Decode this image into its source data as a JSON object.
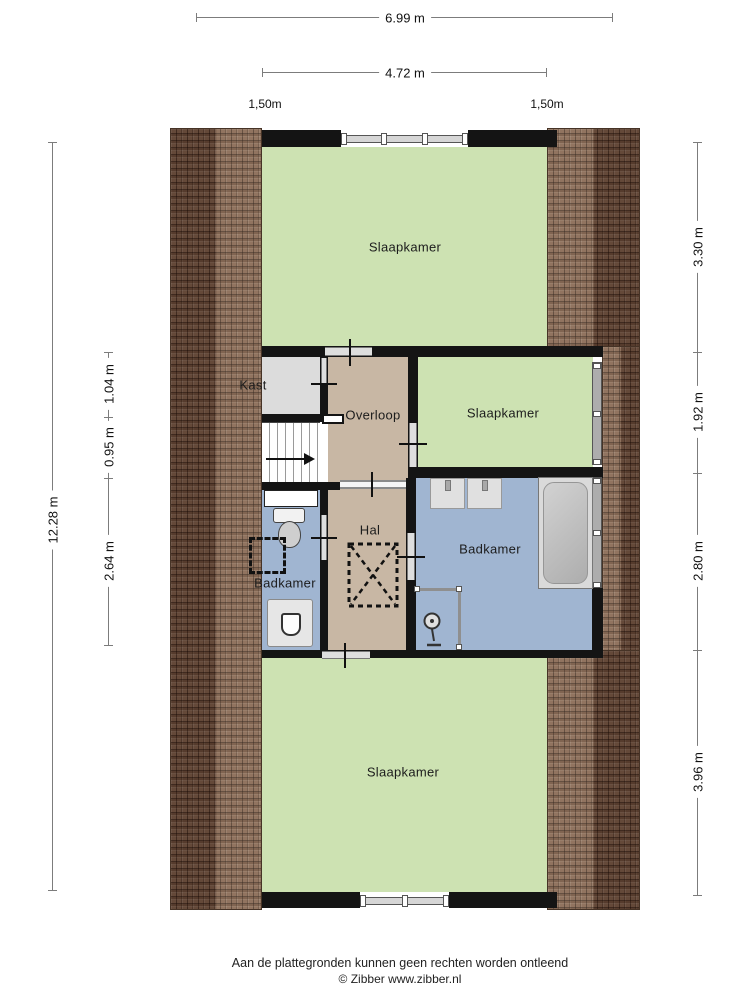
{
  "dimensions": {
    "top": {
      "overall": "6.99 m",
      "inner": "4.72 m",
      "left_eave": "1,50m",
      "right_eave": "1,50m"
    },
    "left": {
      "overall": "12.28 m",
      "segments": [
        "1.04 m",
        "0.95 m",
        "2.64 m"
      ]
    },
    "right": {
      "segments": [
        "3.30 m",
        "1.92 m",
        "2.80 m",
        "3.96 m"
      ]
    }
  },
  "rooms": {
    "slaapkamer_top": "Slaapkamer",
    "kast": "Kast",
    "overloop": "Overloop",
    "slaapkamer_right": "Slaapkamer",
    "hal": "Hal",
    "badkamer_left": "Badkamer",
    "badkamer_right": "Badkamer",
    "slaapkamer_bottom": "Slaapkamer"
  },
  "footer": {
    "disclaimer": "Aan de plattegronden kunnen geen rechten worden ontleend",
    "copyright": "© Zibber www.zibber.nl"
  },
  "colors": {
    "room_green": "#cde2b2",
    "room_tan": "#c8b7a4",
    "room_blue": "#a0b5d1",
    "room_gray": "#dcdcdc",
    "wall": "#141414",
    "roof": "#7f614d"
  }
}
